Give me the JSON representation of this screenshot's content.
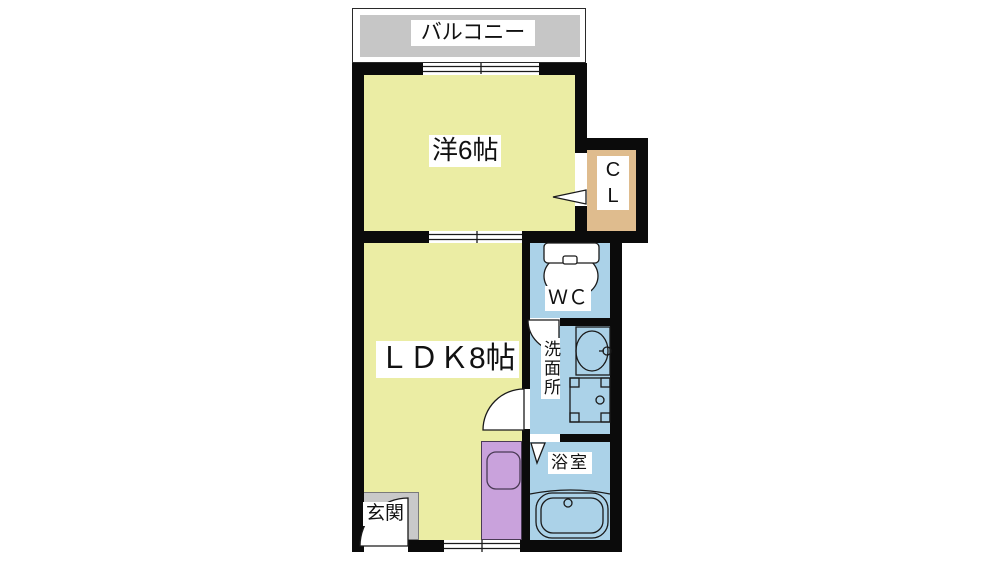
{
  "plan_type": "apartment-floor-plan",
  "rooms": {
    "balcony": {
      "label": "バルコニー"
    },
    "western_room": {
      "label": "洋6帖"
    },
    "closet": {
      "letters": [
        "C",
        "L"
      ]
    },
    "ldk": {
      "label": "ＬＤＫ8帖"
    },
    "wc": {
      "label": "ＷＣ"
    },
    "washroom": {
      "label": "洗面所"
    },
    "bathroom": {
      "label": "浴室"
    },
    "entrance": {
      "label": "玄関"
    }
  },
  "colors": {
    "wall": "#0b0b0b",
    "room_floor": "#ebeda4",
    "wet_area_floor": "#abd2e8",
    "closet_floor": "#dfbc8e",
    "kitchen_counter": "#c9a2dc",
    "balcony_deck": "#c6c6c6",
    "entrance_step": "#c9c9c9",
    "background": "#ffffff"
  },
  "fixtures": [
    "toilet",
    "washbasin",
    "washing-machine-pan",
    "bathtub",
    "kitchen-sink"
  ],
  "openings": [
    "balcony-sliding-window",
    "room-divider-sliding-door",
    "closet-door-arrow",
    "washroom-hinged-door",
    "wc-hinged-door",
    "bathroom-folding-door",
    "entrance-hinged-door",
    "ldk-sliding-window"
  ]
}
